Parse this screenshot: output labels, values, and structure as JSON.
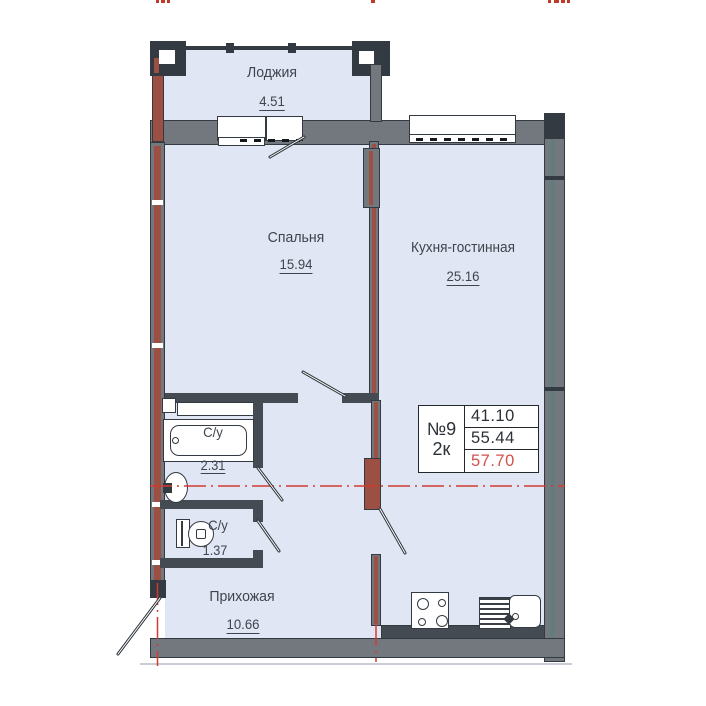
{
  "rooms": [
    {
      "name": "Лоджия",
      "area": "4.51"
    },
    {
      "name": "Спальня",
      "area": "15.94"
    },
    {
      "name": "Кухня-гостинная",
      "area": "25.16"
    },
    {
      "name": "С/у",
      "area": "2.31"
    },
    {
      "name": "С/у",
      "area": "1.37"
    },
    {
      "name": "Прихожая",
      "area": "10.66"
    }
  ],
  "info_table": {
    "apartment_number": "№9",
    "room_count": "2к",
    "living_area": "41.10",
    "floor_area": "55.44",
    "total_area": "57.70"
  },
  "colors": {
    "room_fill": "#e1e6f4",
    "wall_gray": "#73787f",
    "wall_dark": "#343a41",
    "masonry_red": "#9c5044",
    "axis_red": "#d23b30",
    "total_red": "#d4524c"
  }
}
